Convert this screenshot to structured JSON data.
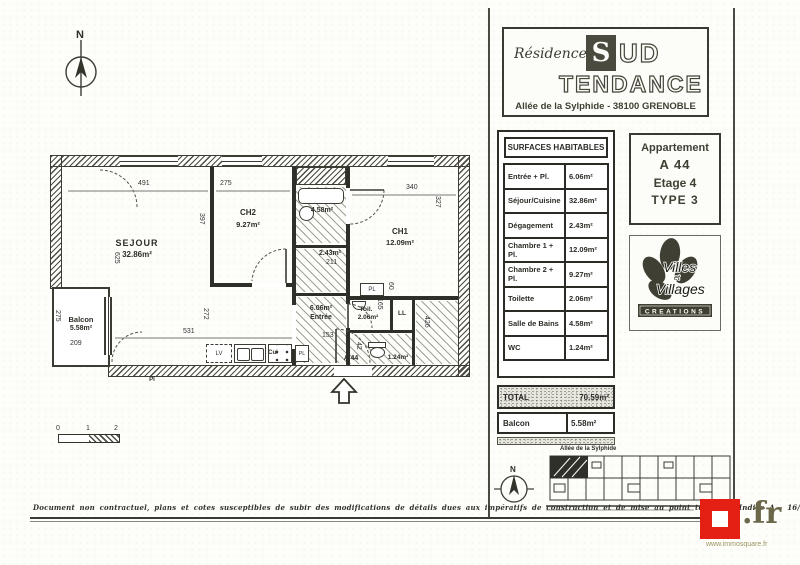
{
  "header": {
    "residence": "Résidence",
    "name_s": "S",
    "name_ud": "UD",
    "name_bottom": "TENDANCE",
    "address": "Allée de la Sylphide - 38100 GRENOBLE"
  },
  "surfaces": {
    "title": "SURFACES HABITABLES",
    "rows": [
      {
        "label": "Entrée + Pl.",
        "value": "6.06m²"
      },
      {
        "label": "Séjour/Cuisine",
        "value": "32.86m²"
      },
      {
        "label": "Dégagement",
        "value": "2.43m²"
      },
      {
        "label": "Chambre 1 + Pl.",
        "value": "12.09m²"
      },
      {
        "label": "Chambre 2 + Pl.",
        "value": "9.27m²"
      },
      {
        "label": "Toilette",
        "value": "2.06m²"
      },
      {
        "label": "Salle de Bains",
        "value": "4.58m²"
      },
      {
        "label": "WC",
        "value": "1.24m²"
      }
    ],
    "total": {
      "label": "TOTAL",
      "value": "70.59m²"
    },
    "balcon": {
      "label": "Balcon",
      "value": "5.58m²"
    }
  },
  "apartment": {
    "line1": "Appartement",
    "line2": "A 44",
    "line3": "Etage 4",
    "line4": "TYPE 3"
  },
  "builder": {
    "word1": "Villes",
    "word2": "et",
    "word3": "Villages",
    "banner": "CREATIONS"
  },
  "siteplan": {
    "street": "Allée de la Sylphide",
    "compass_n": "N"
  },
  "plan": {
    "compass_n": "N",
    "rooms": {
      "sejour": {
        "name": "SEJOUR",
        "area": "32.86m²"
      },
      "ch2": {
        "name": "CH2",
        "area": "9.27m²"
      },
      "ch1": {
        "name": "CH1",
        "area": "12.09m²"
      },
      "balcon": {
        "name": "Balcon",
        "area": "5.58m²"
      },
      "entree": {
        "name": "Entrée",
        "area": "6.06m²"
      },
      "toilette": {
        "name": "Toil.",
        "area": "2.06m²"
      },
      "sdb": {
        "area": "4.58m²"
      },
      "degagement": {
        "area": "2.43m²"
      },
      "wc": {
        "area": "1.24m²"
      }
    },
    "dims": {
      "sejour_w": "491",
      "ch2_w": "275",
      "ch1_w": "340",
      "ch1_h": "327",
      "ch2_h": "397",
      "sejour_h": "625",
      "sejour_h2": "272",
      "sejour_w2": "531",
      "balcon_h": "275",
      "balcon_w": "209",
      "entree_w": "153",
      "toil_w": "165",
      "pl_d": "60",
      "wc_h": "426",
      "deg_w": "211",
      "wc_w": "42"
    },
    "fixtures": {
      "lv": "LV",
      "cui": "Cui",
      "pl1": "PL",
      "pl2": "PL",
      "pl3": "Pl",
      "ll": "LL"
    },
    "door_label": "A 44",
    "scale": {
      "s0": "0",
      "s1": "1",
      "s2": "2"
    }
  },
  "footer": {
    "disclaimer": "Document non contractuel, plans et cotes susceptibles de subir des modifications de détails dues aux impératifs de construction et de mise au point technique.",
    "index": "Indice A - 16/07/2004"
  },
  "brand": {
    "tld": ".fr",
    "url": "www.immosquare.fr"
  }
}
